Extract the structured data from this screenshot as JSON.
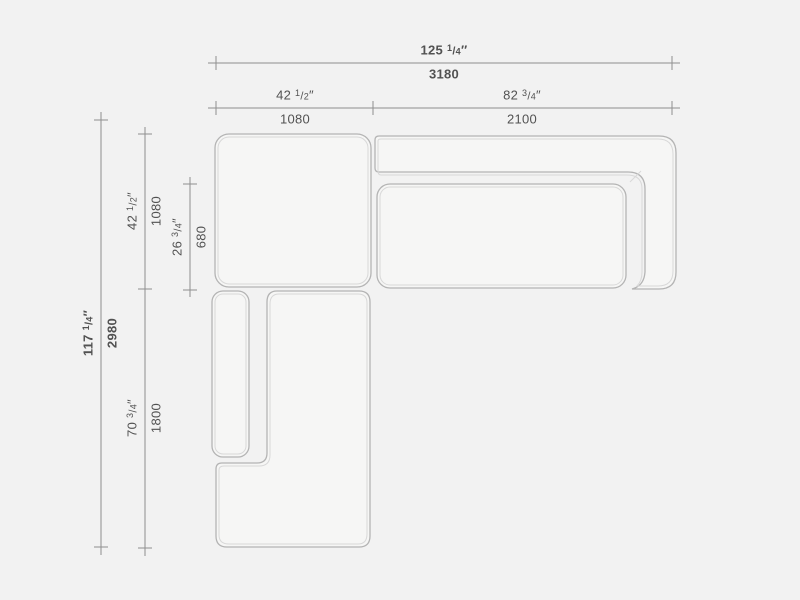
{
  "drawing": {
    "title": "sectional-sofa-top-view-technical-drawing",
    "colors": {
      "background": "#f2f2f2",
      "module_fill": "#f6f6f5",
      "outline": "#b4b4b4",
      "inner_line": "#d8d8d8",
      "dimension_line": "#8f8f8f",
      "text": "#525252"
    }
  },
  "dimensions": {
    "overall_width": {
      "inches_whole": "125",
      "frac_num": "1",
      "frac_den": "4",
      "unit": "″",
      "mm": "3180"
    },
    "left_module_width": {
      "inches_whole": "42",
      "frac_num": "1",
      "frac_den": "2",
      "unit": "″",
      "mm": "1080"
    },
    "right_module_width": {
      "inches_whole": "82",
      "frac_num": "3",
      "frac_den": "4",
      "unit": "″",
      "mm": "2100"
    },
    "overall_depth": {
      "inches_whole": "117",
      "frac_num": "1",
      "frac_den": "4",
      "unit": "″",
      "mm": "2980"
    },
    "corner_module_depth": {
      "inches_whole": "42",
      "frac_num": "1",
      "frac_den": "2",
      "unit": "″",
      "mm": "1080"
    },
    "seat_depth": {
      "inches_whole": "26",
      "frac_num": "3",
      "frac_den": "4",
      "unit": "″",
      "mm": "680"
    },
    "chaise_length": {
      "inches_whole": "70",
      "frac_num": "3",
      "frac_den": "4",
      "unit": "″",
      "mm": "1800"
    }
  }
}
